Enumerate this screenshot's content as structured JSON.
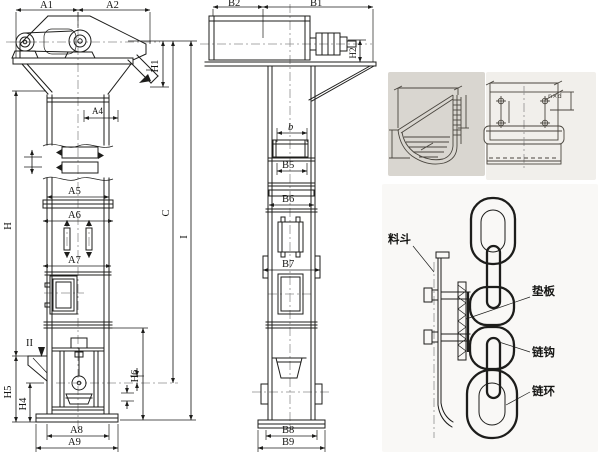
{
  "drawing": {
    "kind": "bucket-elevator-technical-drawing",
    "colors": {
      "ink": "#1d1d1b",
      "centerline": "#8f8f8f",
      "scan_panel": "#d9d6d0",
      "scan_panel_light": "#f1efeb",
      "paper": "#ffffff"
    }
  },
  "front_view": {
    "dims": {
      "a1": "A1",
      "a2": "A2",
      "a4": "A4",
      "a5": "A5",
      "a6": "A6",
      "a7": "A7",
      "a8": "A8",
      "a9": "A9",
      "h": "H",
      "h1": "H1",
      "h4": "H4",
      "h5": "H5",
      "h6": "H6",
      "c": "C",
      "i": "I"
    },
    "sections": {
      "i": "I",
      "ii": "II"
    }
  },
  "side_view": {
    "dims": {
      "b1": "B1",
      "b2": "B2",
      "b": "b",
      "b5": "B5",
      "b6": "B6",
      "b7": "B7",
      "b8": "B8",
      "b9": "B9",
      "h2": "H2"
    }
  },
  "plate_detail": {
    "holes_note": "n×d"
  },
  "chain_detail": {
    "labels": {
      "bucket": "料斗",
      "pad_plate": "垫板",
      "chain_hook": "链钩",
      "chain_link": "链环"
    }
  }
}
